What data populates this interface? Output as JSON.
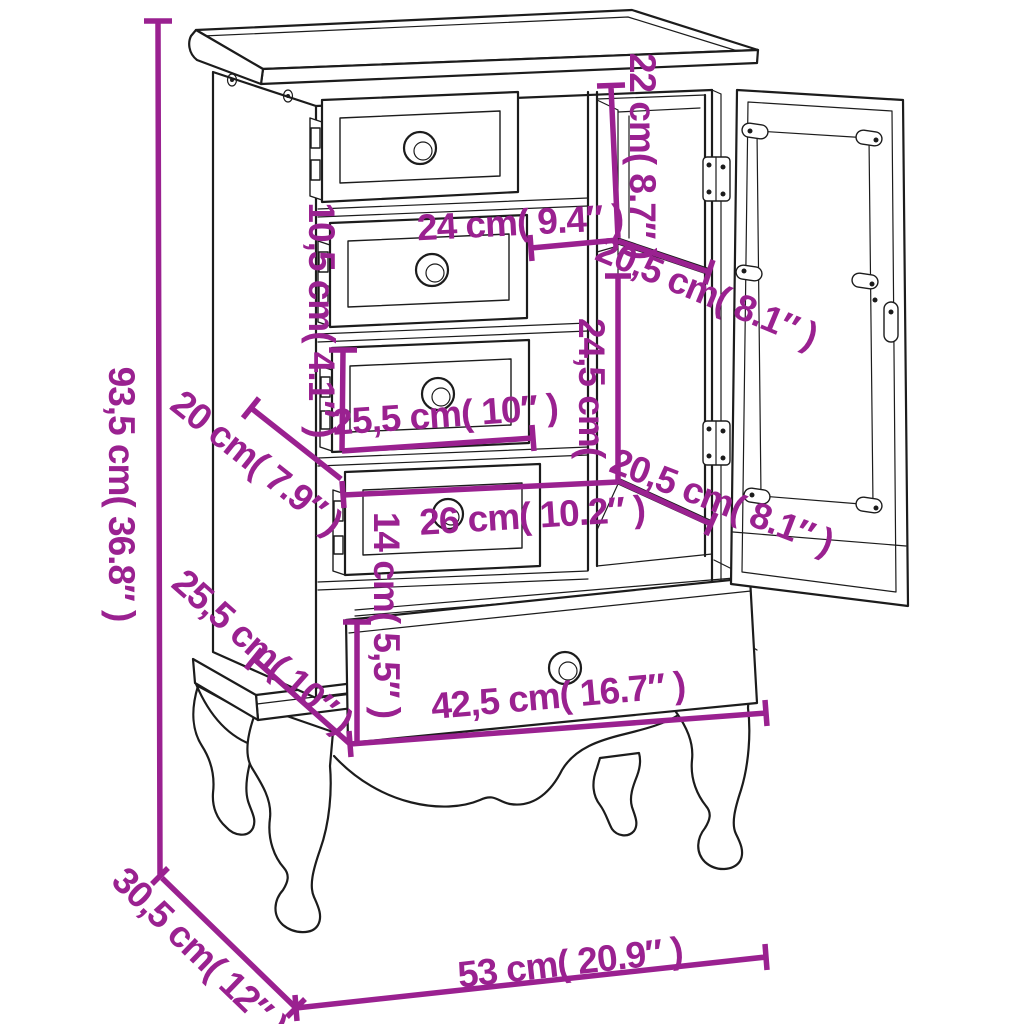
{
  "diagram": {
    "kind": "furniture-dimension-diagram",
    "subject": "cabinet with four small drawers, glass door compartment, bottom drawer and cabriole legs",
    "background": "#ffffff",
    "line_color": "#1c1c1c",
    "accent_color": "#9a2190",
    "dims": [
      {
        "id": "overall-height",
        "text": "93,5 cm( 36.8″ )"
      },
      {
        "id": "top-section-depth",
        "text": "20 cm( 7.9″ )"
      },
      {
        "id": "small-drawer-height",
        "text": "10,5 cm( 4.1″ )"
      },
      {
        "id": "upper-compartment-height",
        "text": "22 cm( 8.7″ )"
      },
      {
        "id": "upper-compartment-width",
        "text": "24 cm( 9.4″ )"
      },
      {
        "id": "shelf-depth-upper",
        "text": "20,5 cm( 8.1″ )"
      },
      {
        "id": "interior-height",
        "text": "24,5 cm("
      },
      {
        "id": "middle-drawer-width",
        "text": "25,5 cm( 10″ )"
      },
      {
        "id": "lower-section-depth",
        "text": "25,5 cm( 10″ )"
      },
      {
        "id": "shelf-depth-lower",
        "text": "20,5 cm( 8.1″ )"
      },
      {
        "id": "lower-drawer-width",
        "text": "26 cm( 10.2″ )"
      },
      {
        "id": "bottom-drawer-height",
        "text": "14 cm( 5,5″ )"
      },
      {
        "id": "bottom-drawer-width",
        "text": "42,5 cm( 16.7″ )"
      },
      {
        "id": "base-depth",
        "text": "30,5 cm( 12″ )"
      },
      {
        "id": "overall-width",
        "text": "53 cm( 20.9″ )"
      }
    ]
  }
}
